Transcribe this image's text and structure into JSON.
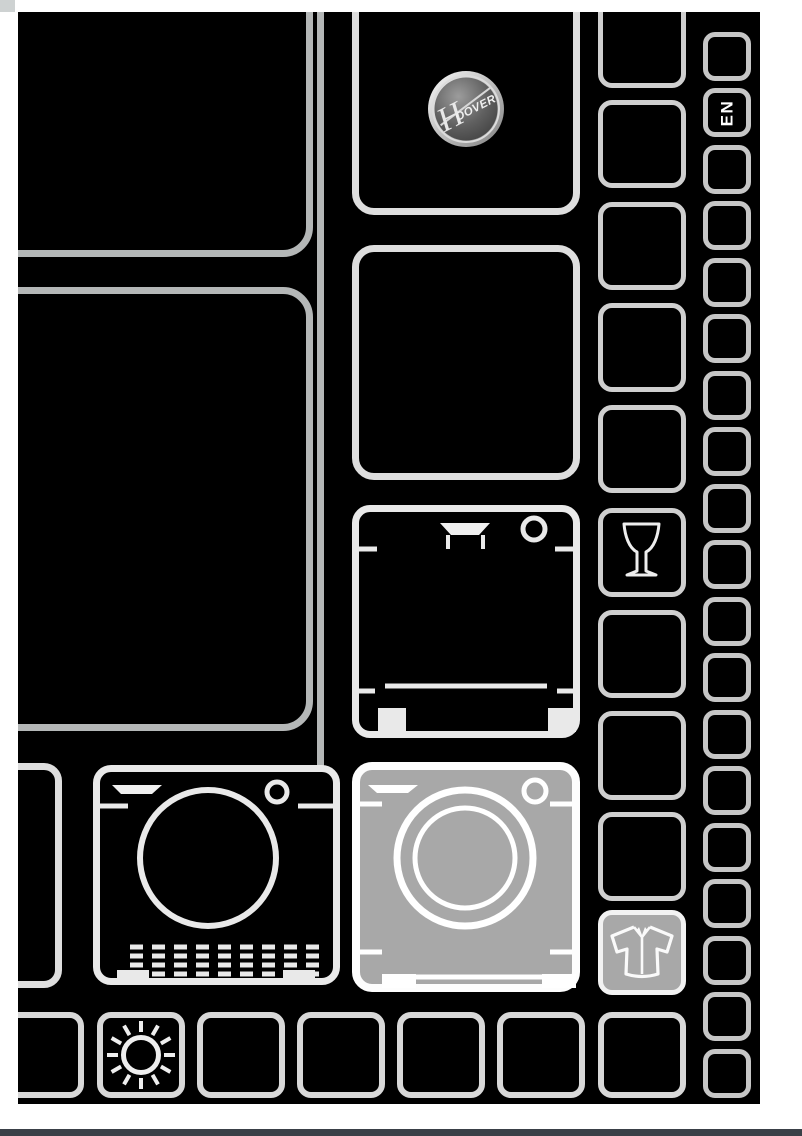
{
  "page": {
    "kind": "appliance manual cover",
    "language_tab": "EN",
    "brand_logo": {
      "full": "HOOVER",
      "initial": "H",
      "rest": "OOVER"
    },
    "icons": [
      "hoover-logo",
      "language-tab-en",
      "wine-glass-icon",
      "dishwasher-icon",
      "tumble-dryer-icon",
      "washing-machine-icon",
      "shirt-icon",
      "sun-icon"
    ],
    "colors": {
      "page_background": "#ffffff",
      "cover_background": "#000000",
      "panel_outline_gray": "#b4b7b7",
      "tile_outline_light": "#e9e9e9",
      "tile_outline_mid": "#dedede",
      "tile_outline_dim": "#c6c6c6",
      "highlight_tile_fill": "#a8a8a8",
      "icon_stroke": "#f0f0f0",
      "footer_bar": "#3a4047",
      "logo_ring": "#dcdcdc",
      "logo_disc": "#565656"
    }
  }
}
